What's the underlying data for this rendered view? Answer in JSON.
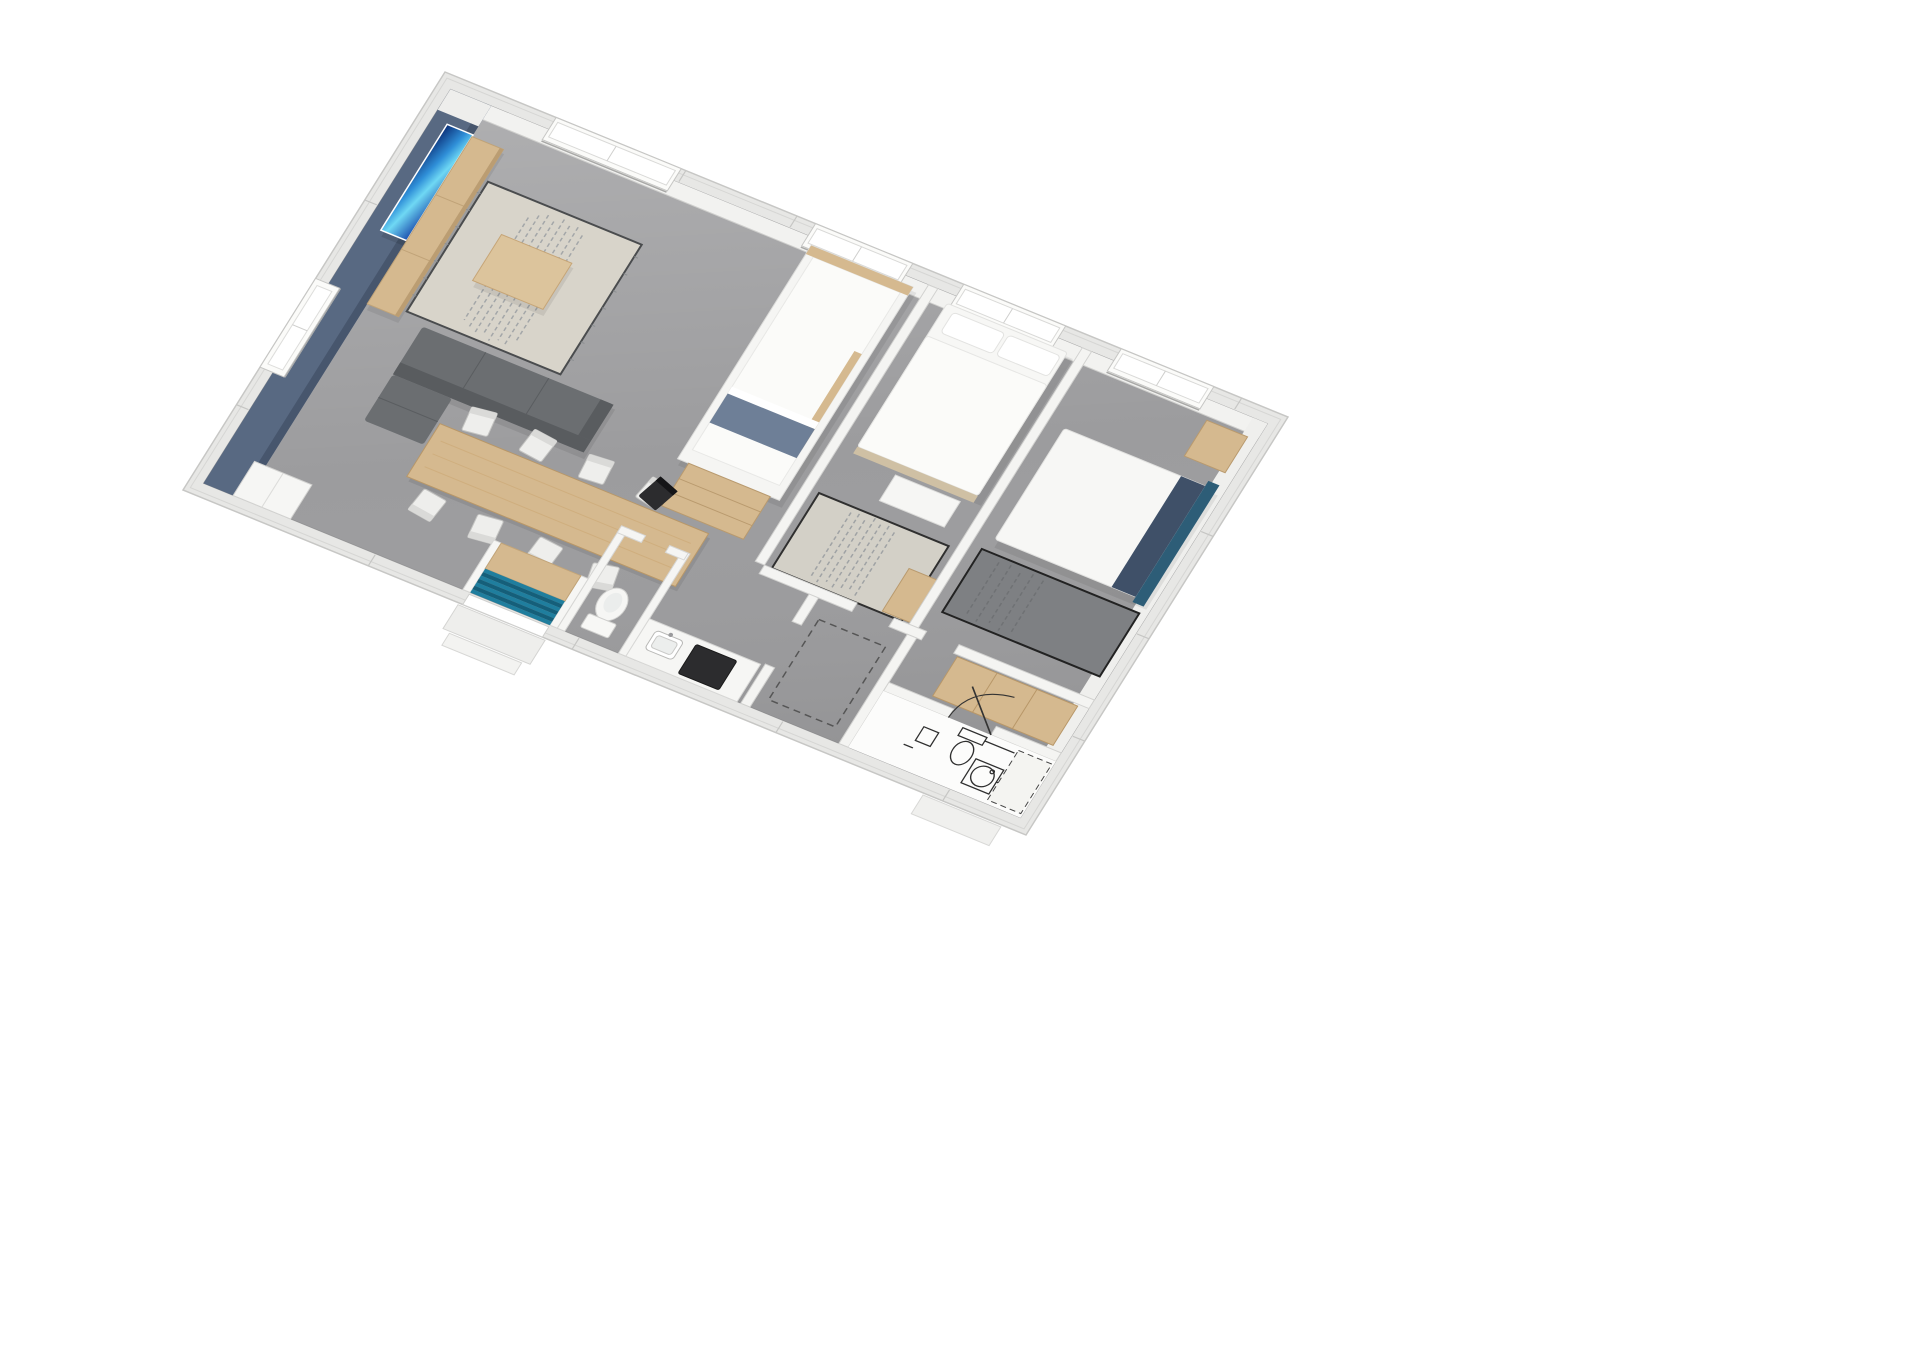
{
  "scene": {
    "type": "3d-floorplan-render",
    "view": "isometric-birdseye",
    "background": "#ffffff",
    "rotation_deg": 22
  },
  "colors": {
    "background": "#ffffff",
    "floor": "#9c9c9e",
    "wall_outer": "#e7e7e5",
    "wall_fill": "#f2f2f0",
    "wall_stroke": "#d2d2d0",
    "accent_wall": "#586982",
    "accent_wall_dark": "#47566d",
    "wood": "#d5b98f",
    "wood_light": "#dcc49c",
    "wood_dark": "#bb9d72",
    "sofa": "#6b6e71",
    "sofa_dark": "#595c5f",
    "rug_living": "#d8d4ca",
    "rug_bed1": "#d3d0c7",
    "rug_bed2": "#7e8083",
    "stairs_teal": "#1f7e9e",
    "stairs_teal_dark": "#155f7a",
    "navy": "#3f5068",
    "headboard_teal": "#2d5d77",
    "loft_blanket": "#6e7f97",
    "bed_base": "#cfc0a4",
    "white_furniture": "#f6f6f4",
    "cooktop": "#2c2c2e",
    "chair_black": "#2c2c2e",
    "fixture_line": "#2f2f2f",
    "tv_1": "#0b2f77",
    "tv_2": "#2f8fd8",
    "tv_3": "#6fd8f4",
    "tv_4": "#1d4fae"
  },
  "inventory": {
    "windows_top_wall": 4,
    "windows_left_wall": 1,
    "dining_chairs": 8,
    "stair_treads": 7,
    "beds": 3,
    "exterior_steps": 2
  },
  "rooms": [
    {
      "name": "living-dining",
      "furniture": [
        "wall-tv",
        "tv-sideboard",
        "area-rug",
        "coffee-table",
        "corner-sofa",
        "dining-table",
        "dining-chairs",
        "corner-cabinet"
      ]
    },
    {
      "name": "entry",
      "furniture": [
        "teal-staircase",
        "wood-landing",
        "entry-door",
        "exterior-steps"
      ]
    },
    {
      "name": "kitchen",
      "furniture": [
        "counter",
        "sink",
        "cooktop"
      ]
    },
    {
      "name": "wc",
      "furniture": [
        "toilet"
      ]
    },
    {
      "name": "kids-nook",
      "furniture": [
        "loft-bunk-bed",
        "bookshelf-desk",
        "desk-chair"
      ]
    },
    {
      "name": "bedroom-1",
      "furniture": [
        "double-bed",
        "foot-dresser",
        "area-rug",
        "wood-chest"
      ]
    },
    {
      "name": "bedroom-2",
      "furniture": [
        "double-bed",
        "navy-pillows",
        "teal-headboard",
        "wood-nightstand",
        "dark-rug",
        "sliding-wardrobe"
      ]
    },
    {
      "name": "utility",
      "furniture": [
        "appliance-space-dashed"
      ]
    },
    {
      "name": "bathroom",
      "furniture": [
        "toilet-2d-symbol",
        "washbasin-2d-symbol",
        "shower-dashed-outline",
        "door-swing-arc"
      ]
    }
  ]
}
